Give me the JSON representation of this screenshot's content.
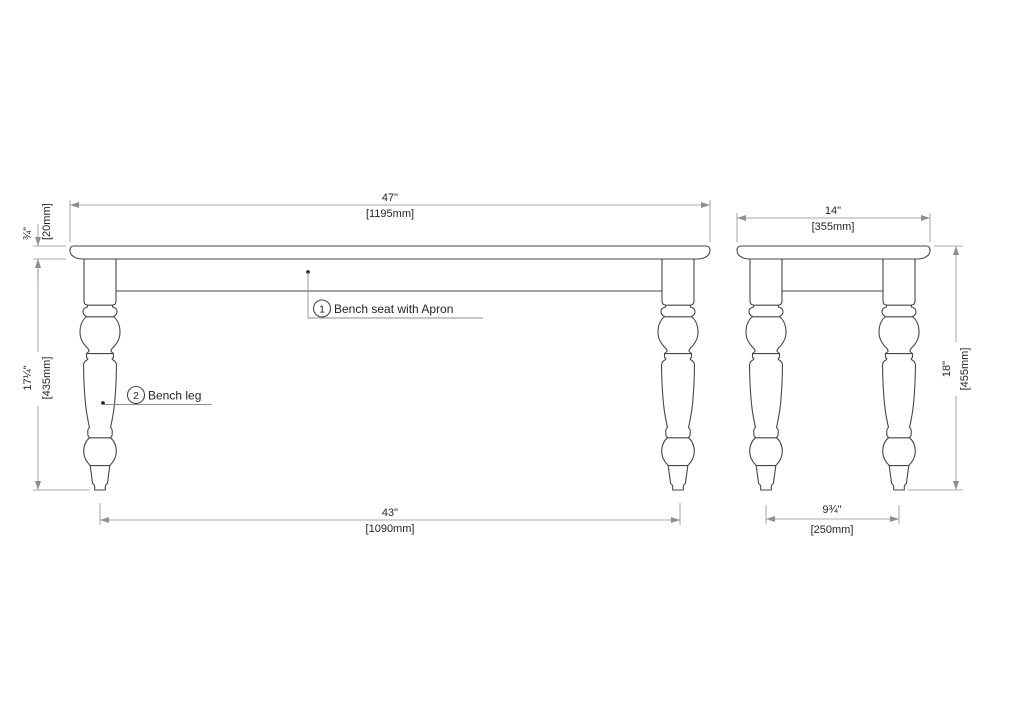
{
  "callouts": [
    {
      "number": "1",
      "label": "Bench seat with Apron"
    },
    {
      "number": "2",
      "label": "Bench leg"
    }
  ],
  "dimensions": {
    "front_width": {
      "inches": "47\"",
      "mm": "[1195mm]"
    },
    "top_thickness": {
      "inches": "¾\"",
      "mm": "[20mm]"
    },
    "leg_height": {
      "inches": "17¼\"",
      "mm": "[435mm]"
    },
    "front_leg_span": {
      "inches": "43\"",
      "mm": "[1090mm]"
    },
    "side_depth": {
      "inches": "14\"",
      "mm": "[355mm]"
    },
    "overall_height": {
      "inches": "18\"",
      "mm": "[455mm]"
    },
    "side_leg_span": {
      "inches": "9¾\"",
      "mm": "[250mm]"
    }
  },
  "colors": {
    "object_line": "#474747",
    "dimension_line": "#8f8f8f",
    "text": "#242424",
    "background": "#ffffff"
  }
}
